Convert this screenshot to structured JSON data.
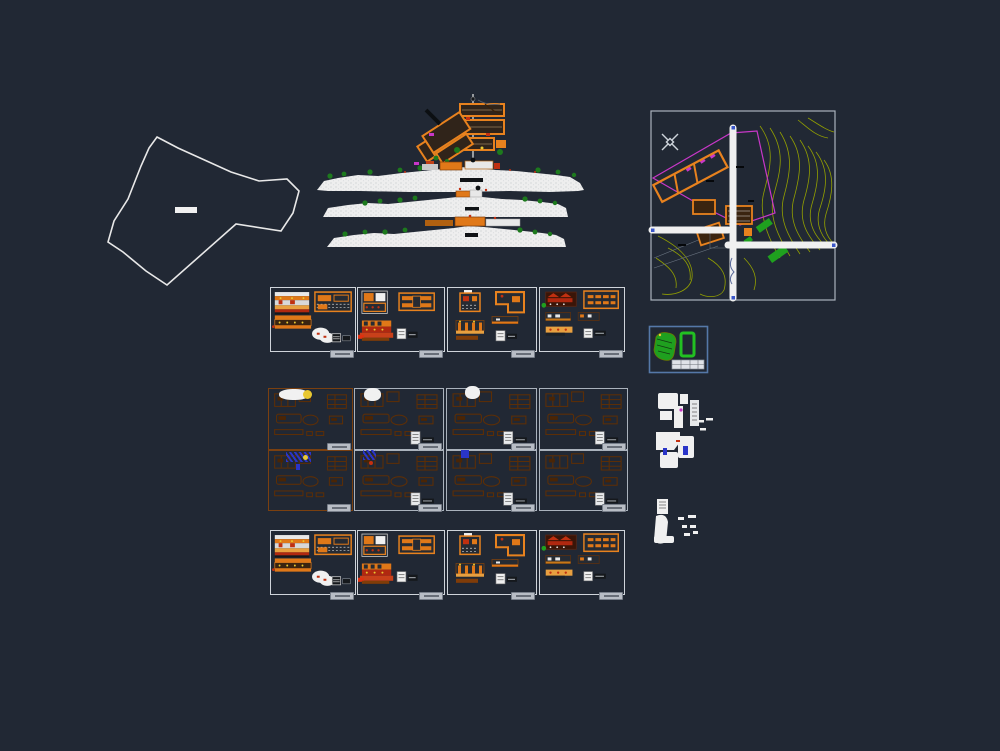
{
  "canvas": {
    "background": "#212834",
    "content": "architectural CAD drawing set"
  },
  "palette": {
    "background": "#212834",
    "line_white": "#f1f1f1",
    "orange": "#e8821e",
    "orange_dim": "#5c2e06",
    "orange_border": "#7a4010",
    "red": "#c43010",
    "yellow": "#e8c832",
    "green": "#1fa01f",
    "tree_green": "#1d7a1d",
    "contour_olive": "#93a000",
    "magenta": "#c837c8",
    "blue": "#2a35c8",
    "sheet_border": "#cfd4da",
    "tab_gray": "#b8bdc5",
    "detail_border_blue": "#5578a8"
  },
  "panels": {
    "site_location": {
      "kind": "boundary-polygon"
    },
    "master_plan": {
      "kind": "roof-plan-and-three-elevations"
    },
    "site_plan": {
      "kind": "topographic-site-plan-with-roads"
    },
    "green_detail": {
      "kind": "small-green-detail-sheet"
    },
    "white_cluster_upper": {
      "kind": "unit-plan-cluster"
    },
    "white_cluster_lower": {
      "kind": "unit-plan-cluster"
    }
  },
  "sheet_groups": [
    {
      "name": "upper-row",
      "y": 287,
      "h": 65,
      "label_y": 350,
      "sheets": [
        {
          "x": 270,
          "w": 86,
          "variant": "v1",
          "border": "#cfd4da",
          "label": true
        },
        {
          "x": 357,
          "w": 88,
          "variant": "v2",
          "border": "#cfd4da",
          "label": true
        },
        {
          "x": 447,
          "w": 90,
          "variant": "v3",
          "border": "#cfd4da",
          "label": true
        },
        {
          "x": 539,
          "w": 86,
          "variant": "v4",
          "border": "#cfd4da",
          "label": true
        }
      ]
    },
    {
      "name": "middle-row-1",
      "y": 388,
      "h": 62,
      "label_y": 443,
      "sheets": [
        {
          "x": 268,
          "w": 85,
          "variant": "dim",
          "border": "#7a4010",
          "label": true,
          "stamp": false
        },
        {
          "x": 354,
          "w": 90,
          "variant": "dim",
          "border": "#aab2bc",
          "label": true,
          "stamp": true
        },
        {
          "x": 446,
          "w": 91,
          "variant": "dim",
          "border": "#aab2bc",
          "label": true,
          "stamp": true
        },
        {
          "x": 539,
          "w": 89,
          "variant": "dim",
          "border": "#aab2bc",
          "label": true,
          "stamp": true
        }
      ]
    },
    {
      "name": "middle-row-2",
      "y": 450,
      "h": 61,
      "label_y": 504,
      "sheets": [
        {
          "x": 268,
          "w": 85,
          "variant": "dim",
          "border": "#7a4010",
          "label": true,
          "stamp": false
        },
        {
          "x": 354,
          "w": 90,
          "variant": "dim",
          "border": "#aab2bc",
          "label": true,
          "stamp": true
        },
        {
          "x": 446,
          "w": 91,
          "variant": "dim",
          "border": "#aab2bc",
          "label": true,
          "stamp": true
        },
        {
          "x": 539,
          "w": 89,
          "variant": "dim",
          "border": "#aab2bc",
          "label": true,
          "stamp": true
        }
      ]
    },
    {
      "name": "lower-row",
      "y": 530,
      "h": 65,
      "label_y": 592,
      "sheets": [
        {
          "x": 270,
          "w": 86,
          "variant": "v1",
          "border": "#cfd4da",
          "label": true
        },
        {
          "x": 357,
          "w": 88,
          "variant": "v2",
          "border": "#cfd4da",
          "label": true
        },
        {
          "x": 447,
          "w": 90,
          "variant": "v3",
          "border": "#cfd4da",
          "label": true
        },
        {
          "x": 539,
          "w": 86,
          "variant": "v4",
          "border": "#cfd4da",
          "label": true
        }
      ]
    }
  ],
  "accents": [
    {
      "kind": "cloud",
      "x": 279,
      "y": 389,
      "w": 30,
      "h": 11
    },
    {
      "kind": "sun",
      "x": 303,
      "y": 390,
      "w": 9,
      "h": 9
    },
    {
      "kind": "cloud",
      "x": 364,
      "y": 388,
      "w": 17,
      "h": 13
    },
    {
      "kind": "cloud",
      "x": 465,
      "y": 386,
      "w": 15,
      "h": 13
    },
    {
      "kind": "scribble",
      "x": 286,
      "y": 452,
      "w": 25,
      "h": 10
    },
    {
      "kind": "sun",
      "x": 303,
      "y": 455,
      "w": 5,
      "h": 5
    },
    {
      "kind": "blue",
      "x": 296,
      "y": 464,
      "w": 4,
      "h": 6
    },
    {
      "kind": "scribble",
      "x": 363,
      "y": 450,
      "w": 13,
      "h": 10
    },
    {
      "kind": "red",
      "x": 369,
      "y": 461,
      "w": 4,
      "h": 4
    },
    {
      "kind": "blue",
      "x": 461,
      "y": 450,
      "w": 8,
      "h": 8
    }
  ]
}
